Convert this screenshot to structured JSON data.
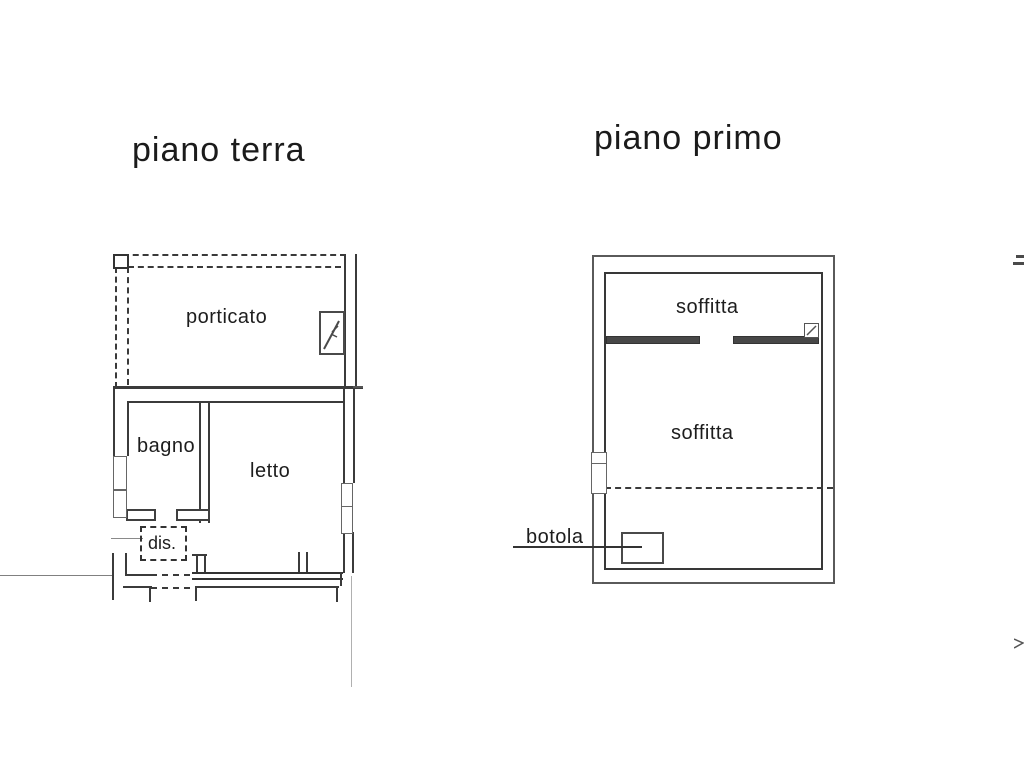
{
  "document": {
    "type": "scanned floor plan (planimetria catastale)",
    "language": "Italian"
  },
  "colors": {
    "paper": "#ffffff",
    "wall_line": "#3b3b3b",
    "faint_line": "#b0b0b0",
    "text": "#1b1b1b"
  },
  "plans": [
    {
      "id": "piano-terra",
      "title": "piano terra",
      "rooms": [
        {
          "label": "porticato"
        },
        {
          "label": "bagno"
        },
        {
          "label": "letto"
        },
        {
          "label": "dis."
        }
      ]
    },
    {
      "id": "piano-primo",
      "title": "piano primo",
      "rooms": [
        {
          "label": "soffitta"
        },
        {
          "label": "soffitta"
        },
        {
          "label": "botola"
        }
      ]
    }
  ]
}
